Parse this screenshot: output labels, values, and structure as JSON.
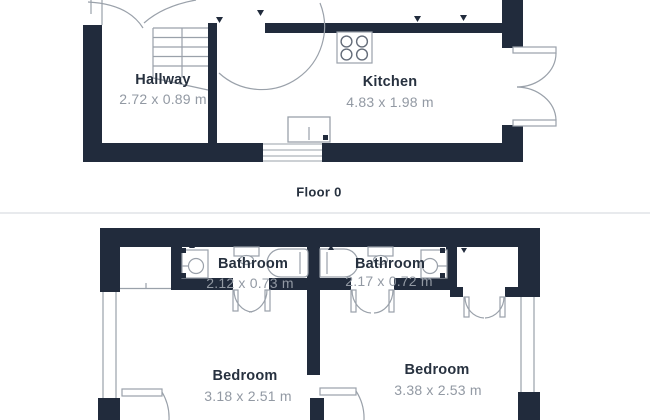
{
  "floors": [
    {
      "caption": "Floor 0",
      "rooms": [
        {
          "name": "Hallway",
          "dimensions": "2.72 x 0.89 m"
        },
        {
          "name": "Kitchen",
          "dimensions": "4.83 x 1.98 m"
        }
      ]
    },
    {
      "rooms": [
        {
          "name": "Bathroom",
          "dimensions": "2.12 x 0.73 m"
        },
        {
          "name": "Bathroom",
          "dimensions": "2.17 x 0.72 m"
        },
        {
          "name": "Bedroom",
          "dimensions": "3.18 x 2.51 m"
        },
        {
          "name": "Bedroom",
          "dimensions": "3.38 x 2.53 m"
        }
      ]
    }
  ],
  "colors": {
    "wall": "#212b3c",
    "label": "#27313f",
    "dimension": "#9299a3",
    "outline": "#9aa1aa",
    "outline-strong": "#646c79",
    "divider": "#e8eaed",
    "bg": "#ffffff"
  }
}
